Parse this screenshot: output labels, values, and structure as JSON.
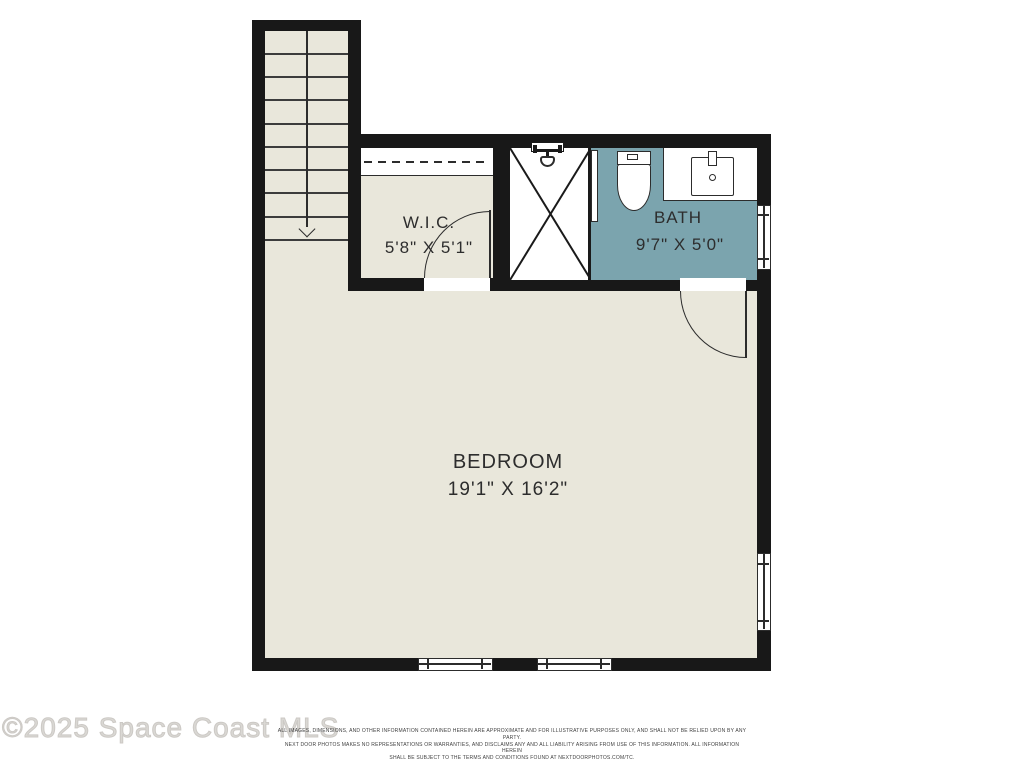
{
  "watermark": "©2025 Space Coast MLS",
  "disclaimer": {
    "line1": "ALL IMAGES, DIMENSIONS, AND OTHER INFORMATION CONTAINED HEREIN ARE APPROXIMATE AND FOR ILLUSTRATIVE PURPOSES ONLY, AND SHALL NOT BE RELIED UPON BY ANY PARTY.",
    "line2": "NEXT DOOR PHOTOS MAKES NO REPRESENTATIONS OR WARRANTIES, AND DISCLAIMS ANY AND ALL LIABILITY ARISING FROM USE OF THIS INFORMATION. ALL INFORMATION HEREIN",
    "line3": "SHALL BE SUBJECT TO THE TERMS AND CONDITIONS FOUND AT NEXTDOORPHOTOS.COM/TC."
  },
  "rooms": {
    "wic": {
      "name": "W.I.C.",
      "dimensions": "5'8\" X 5'1\""
    },
    "bath": {
      "name": "BATH",
      "dimensions": "9'7\" X 5'0\""
    },
    "bedroom": {
      "name": "BEDROOM",
      "dimensions": "19'1\" X 16'2\""
    }
  },
  "icons": {
    "stairs": "stair-down-arrow",
    "fixtures": [
      "shower-head",
      "toilet",
      "sink"
    ]
  },
  "colors": {
    "wall": "#181818",
    "floor": "#e9e7db",
    "bath_floor": "#7ba4ae",
    "text": "#2d2d2d"
  }
}
